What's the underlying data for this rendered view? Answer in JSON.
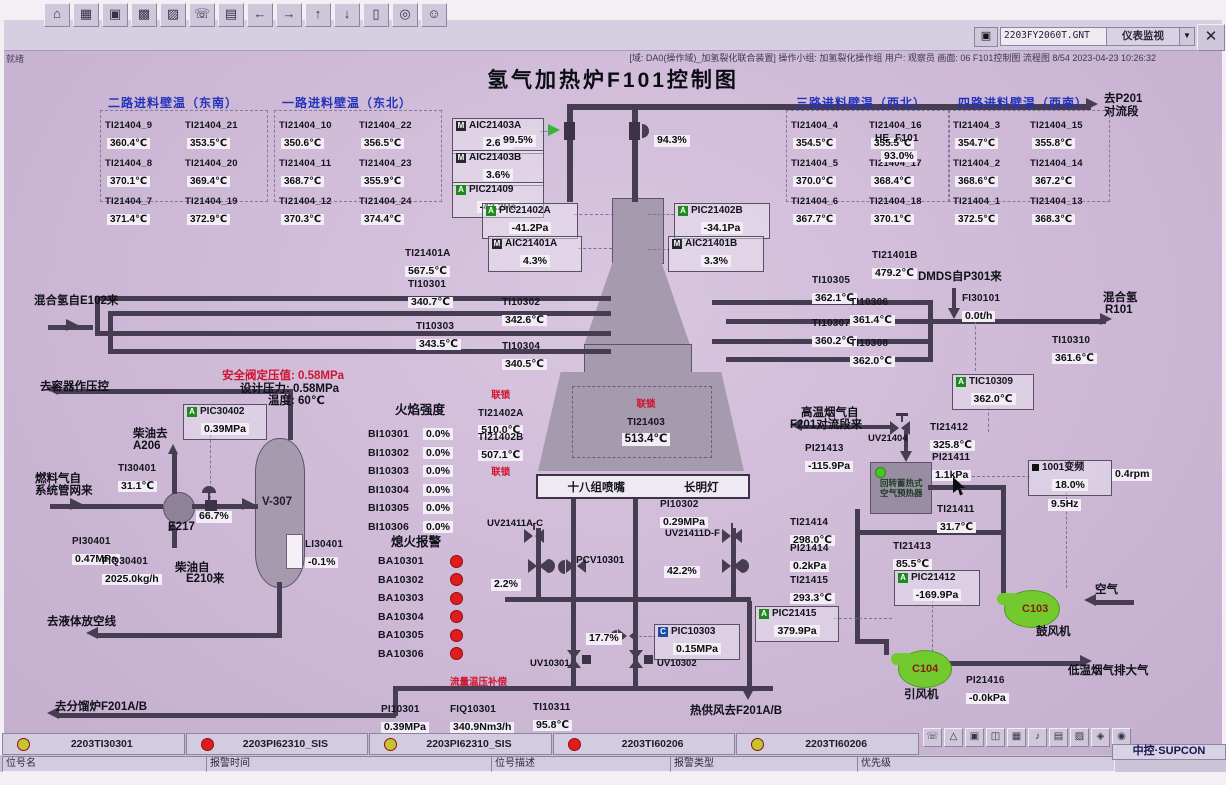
{
  "window": {
    "file": "2203FY2060T.GNT",
    "view": "仪表监视",
    "close": "✕",
    "ready": "就绪",
    "status": "[域: DA0(操作域)_加氢裂化联合装置]  操作小组: 加氢裂化操作组  用户: 观察员  画面: 06 F101控制图  流程图 8/54  2023-04-23 10:26:32"
  },
  "title": "氢气加热炉F101控制图",
  "toolbar_icons": [
    "⌂",
    "▦",
    "▣",
    "▩",
    "▨",
    "☏",
    "▤",
    "←",
    "→",
    "↑",
    "↓",
    "▯",
    "◎",
    "☺"
  ],
  "tray_icons": [
    "☏",
    "△",
    "▣",
    "◫",
    "▦",
    "♪",
    "▤",
    "▨",
    "◈",
    "◉"
  ],
  "wall_groups": [
    {
      "title": "二路进料壁温（东南）",
      "tags": [
        {
          "n": "TI21404_9",
          "v": "360.4℃"
        },
        {
          "n": "TI21404_21",
          "v": "353.5℃"
        },
        {
          "n": "TI21404_8",
          "v": "370.1℃"
        },
        {
          "n": "TI21404_20",
          "v": "369.4℃"
        },
        {
          "n": "TI21404_7",
          "v": "371.4℃"
        },
        {
          "n": "TI21404_19",
          "v": "372.9℃"
        }
      ]
    },
    {
      "title": "一路进料壁温（东北）",
      "tags": [
        {
          "n": "TI21404_10",
          "v": "350.6℃"
        },
        {
          "n": "TI21404_22",
          "v": "356.5℃"
        },
        {
          "n": "TI21404_11",
          "v": "368.7℃"
        },
        {
          "n": "TI21404_23",
          "v": "355.9℃"
        },
        {
          "n": "TI21404_12",
          "v": "370.3℃"
        },
        {
          "n": "TI21404_24",
          "v": "374.4℃"
        }
      ]
    },
    {
      "title": "三路进料壁温（西北）",
      "tags": [
        {
          "n": "TI21404_4",
          "v": "354.5℃"
        },
        {
          "n": "TI21404_16",
          "v": "355.5℃"
        },
        {
          "n": "TI21404_5",
          "v": "370.0℃"
        },
        {
          "n": "TI21404_17",
          "v": "368.4℃"
        },
        {
          "n": "TI21404_6",
          "v": "367.7℃"
        },
        {
          "n": "TI21404_18",
          "v": "370.1℃"
        }
      ]
    },
    {
      "title": "四路进料壁温（西南）",
      "tags": [
        {
          "n": "TI21404_3",
          "v": "354.7℃"
        },
        {
          "n": "TI21404_15",
          "v": "355.8℃"
        },
        {
          "n": "TI21404_2",
          "v": "368.6℃"
        },
        {
          "n": "TI21404_14",
          "v": "367.2℃"
        },
        {
          "n": "TI21404_1",
          "v": "372.5℃"
        },
        {
          "n": "TI21404_13",
          "v": "368.3℃"
        }
      ]
    }
  ],
  "ins": {
    "aic21403a": {
      "l": "AIC21403A",
      "v": "2.6%",
      "c": "M"
    },
    "aic21403b": {
      "l": "AIC21403B",
      "v": "3.6%",
      "c": "M"
    },
    "pic21409": {
      "l": "PIC21409",
      "v": "-42.2Pa",
      "c": "A"
    },
    "pic21402a": {
      "l": "PIC21402A",
      "v": "-41.2Pa",
      "c": "A"
    },
    "pic21402b": {
      "l": "PIC21402B",
      "v": "-34.1Pa",
      "c": "A"
    },
    "aic21401a": {
      "l": "AIC21401A",
      "v": "4.3%",
      "c": "M"
    },
    "aic21401b": {
      "l": "AIC21401B",
      "v": "3.3%",
      "c": "M"
    },
    "he_f101": {
      "l": "HE_F101",
      "v": "93.0%"
    },
    "v995": {
      "v": "99.5%"
    },
    "v943": {
      "v": "94.3%"
    },
    "v667": {
      "v": "66.7%"
    },
    "v22": {
      "v": "2.2%"
    },
    "v422": {
      "v": "42.2%"
    },
    "v177": {
      "v": "17.7%"
    },
    "ti21401a": {
      "l": "TI21401A",
      "v": "567.5℃"
    },
    "ti10301": {
      "l": "TI10301",
      "v": "340.7℃"
    },
    "ti10302": {
      "l": "TI10302",
      "v": "342.6℃"
    },
    "ti10303": {
      "l": "TI10303",
      "v": "343.5℃"
    },
    "ti10304": {
      "l": "TI10304",
      "v": "340.5℃"
    },
    "ti21401b": {
      "l": "TI21401B",
      "v": "479.2℃"
    },
    "ti10305": {
      "l": "TI10305",
      "v": "362.1℃"
    },
    "ti10306": {
      "l": "TI10306",
      "v": "361.4℃"
    },
    "ti10307": {
      "l": "TI10307",
      "v": "360.2℃"
    },
    "ti10308": {
      "l": "TI10308",
      "v": "362.0℃"
    },
    "ti10310": {
      "l": "TI10310",
      "v": "361.6℃"
    },
    "fi30101": {
      "l": "FI30101",
      "v": "0.0t/h"
    },
    "ti21402a": {
      "l": "TI21402A",
      "v": "510.0℃"
    },
    "ti21402b": {
      "l": "TI21402B",
      "v": "507.1℃"
    },
    "ti21403": {
      "l": "TI21403",
      "v": "513.4℃"
    },
    "tic10309": {
      "l": "TIC10309",
      "v": "362.0℃",
      "c": "A"
    },
    "pic30402": {
      "l": "PIC30402",
      "v": "0.39MPa",
      "c": "A"
    },
    "ti30401": {
      "l": "TI30401",
      "v": "31.1℃"
    },
    "pi30401": {
      "l": "PI30401",
      "v": "0.47MPa"
    },
    "fiq30401": {
      "l": "FIQ30401",
      "v": "2025.0kg/h"
    },
    "li30401": {
      "l": "LI30401",
      "v": "-0.1%"
    },
    "pi10302": {
      "l": "PI10302",
      "v": "0.29MPa"
    },
    "pcv10301": {
      "l": "PCV10301"
    },
    "uv21411ac": {
      "l": "UV21411A-C"
    },
    "uv21411df": {
      "l": "UV21411D-F"
    },
    "uv10301": {
      "l": "UV10301"
    },
    "uv10302": {
      "l": "UV10302"
    },
    "uv21404": {
      "l": "UV21404"
    },
    "pic10303": {
      "l": "PIC10303",
      "v": "0.15MPa",
      "c": "C"
    },
    "pi10301": {
      "l": "PI10301",
      "v": "0.39MPa"
    },
    "fiq10301": {
      "l": "FIQ10301",
      "v": "340.9Nm3/h"
    },
    "ti10311": {
      "l": "TI10311",
      "v": "95.8℃"
    },
    "ti21412": {
      "l": "TI21412",
      "v": "325.8℃"
    },
    "pi21413": {
      "l": "PI21413",
      "v": "-115.9Pa"
    },
    "pi21411": {
      "l": "PI21411",
      "v": "1.1kPa"
    },
    "ti21411": {
      "l": "TI21411",
      "v": "31.7℃"
    },
    "ti21414": {
      "l": "TI21414",
      "v": "298.0℃"
    },
    "pi21414": {
      "l": "PI21414",
      "v": "0.2kPa"
    },
    "ti21413": {
      "l": "TI21413",
      "v": "85.5℃"
    },
    "ti21415": {
      "l": "TI21415",
      "v": "293.3℃"
    },
    "pic21412": {
      "l": "PIC21412",
      "v": "-169.9Pa",
      "c": "A"
    },
    "pic21415": {
      "l": "PIC21415",
      "v": "379.9Pa",
      "c": "A"
    },
    "pi21416": {
      "l": "PI21416",
      "v": "-0.0kPa"
    },
    "vfd": {
      "l": "1001变频",
      "v": "18.0%",
      "hz": "9.5Hz",
      "rpm": "0.4rpm"
    },
    "c103": {
      "l": "C103",
      "sub": "鼓风机"
    },
    "c104": {
      "l": "C104",
      "sub": "引风机"
    }
  },
  "labels": {
    "h2_in": "混合氢自E102来",
    "to_vessel": "去容器作压控",
    "sv_set": "安全阀定压值: 0.58MPa",
    "design_p": "设计压力: 0.58MPa",
    "design_t": "温度: 60℃",
    "diesel_to": "柴油去",
    "a206": "A206",
    "fuel1": "燃料气自",
    "fuel2": "系统管网来",
    "e217": "E217",
    "v307": "V-307",
    "diesel_from": "柴油自",
    "e210": "E210来",
    "to_vent": "去液体放空线",
    "to_frac": "去分馏炉F201A/B",
    "flame": "火焰强度",
    "flameout": "熄火报警",
    "burners": "十八组喷嘴",
    "pilot": "长明灯",
    "dmds": "DMDS自P301来",
    "mix_h2": "混合氢",
    "r101": "R101",
    "to_p201_1": "去P201",
    "to_p201_2": "对流段",
    "hot_flue1": "高温烟气自",
    "hot_flue2": "F201对流段来",
    "preheat1": "回转蓄热式",
    "preheat2": "空气预热器",
    "air": "空气",
    "cold_flue": "低温烟气排大气",
    "hot_air": "热供风去F201A/B",
    "comp": "流量温压补偿",
    "interlock": "联锁"
  },
  "bi_list": [
    {
      "n": "BI10301",
      "v": "0.0%"
    },
    {
      "n": "BI10302",
      "v": "0.0%"
    },
    {
      "n": "BI10303",
      "v": "0.0%"
    },
    {
      "n": "BI10304",
      "v": "0.0%"
    },
    {
      "n": "BI10305",
      "v": "0.0%"
    },
    {
      "n": "BI10306",
      "v": "0.0%"
    }
  ],
  "ba_list": [
    "BA10301",
    "BA10302",
    "BA10303",
    "BA10304",
    "BA10305",
    "BA10306"
  ],
  "alarms": [
    {
      "c": "#c6c42e",
      "t": "2203TI30301"
    },
    {
      "c": "#e01c1c",
      "t": "2203PI62310_SIS"
    },
    {
      "c": "#c6c42e",
      "t": "2203PI62310_SIS"
    },
    {
      "c": "#e01c1c",
      "t": "2203TI60206"
    },
    {
      "c": "#c6c42e",
      "t": "2203TI60206"
    }
  ],
  "footer": [
    "位号名",
    "报警时间",
    "位号描述",
    "报警类型",
    "优先级"
  ],
  "brand": "中控·SUPCON",
  "colors": {
    "accent_green": "#1e8a1e",
    "alarm_red": "#e01c1c",
    "alarm_yellow": "#c6c42e",
    "title_blue": "#2433bb"
  }
}
